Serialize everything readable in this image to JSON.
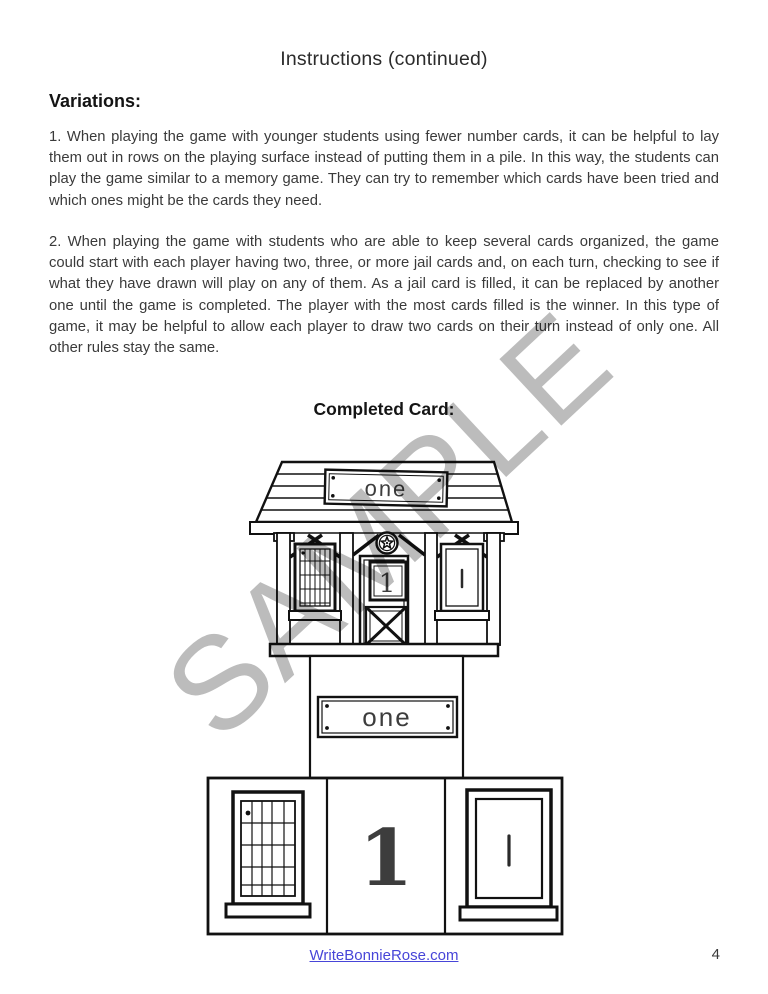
{
  "header": {
    "title": "Instructions (continued)"
  },
  "variations": {
    "heading": "Variations:",
    "paragraphs": [
      "1. When playing the game with younger students using fewer number cards, it can be helpful to lay them out in rows on the playing surface instead of putting them in a pile. In this way, the students can play the game similar to a memory game. They can try to remember which cards have been tried and which ones might be the cards they need.",
      "2. When playing the game with students who are able to keep several cards organized, the game could start with each player having two, three, or more jail cards and, on each turn, checking to see if what they have drawn will play on any of them. As a jail card is filled, it can be replaced by another one until the game is completed. The player with the most cards filled is the winner. In this type of game, it may be helpful to allow each player to draw two cards on their turn instead of only one. All other rules stay the same."
    ]
  },
  "completed_card": {
    "heading": "Completed Card:",
    "house": {
      "roof_sign_label": "one",
      "door_card_number": "1",
      "window_tally_marks": 1
    },
    "pedestal": {
      "sign_label": "one"
    },
    "base_strip": {
      "number": "1",
      "door_tally_marks": 1
    }
  },
  "watermark": {
    "text": "SAMPLE",
    "color": "#bcbcbc"
  },
  "footer": {
    "link_label": "WriteBonnieRose.com",
    "link_color": "#4745d8",
    "page_number": "4"
  }
}
